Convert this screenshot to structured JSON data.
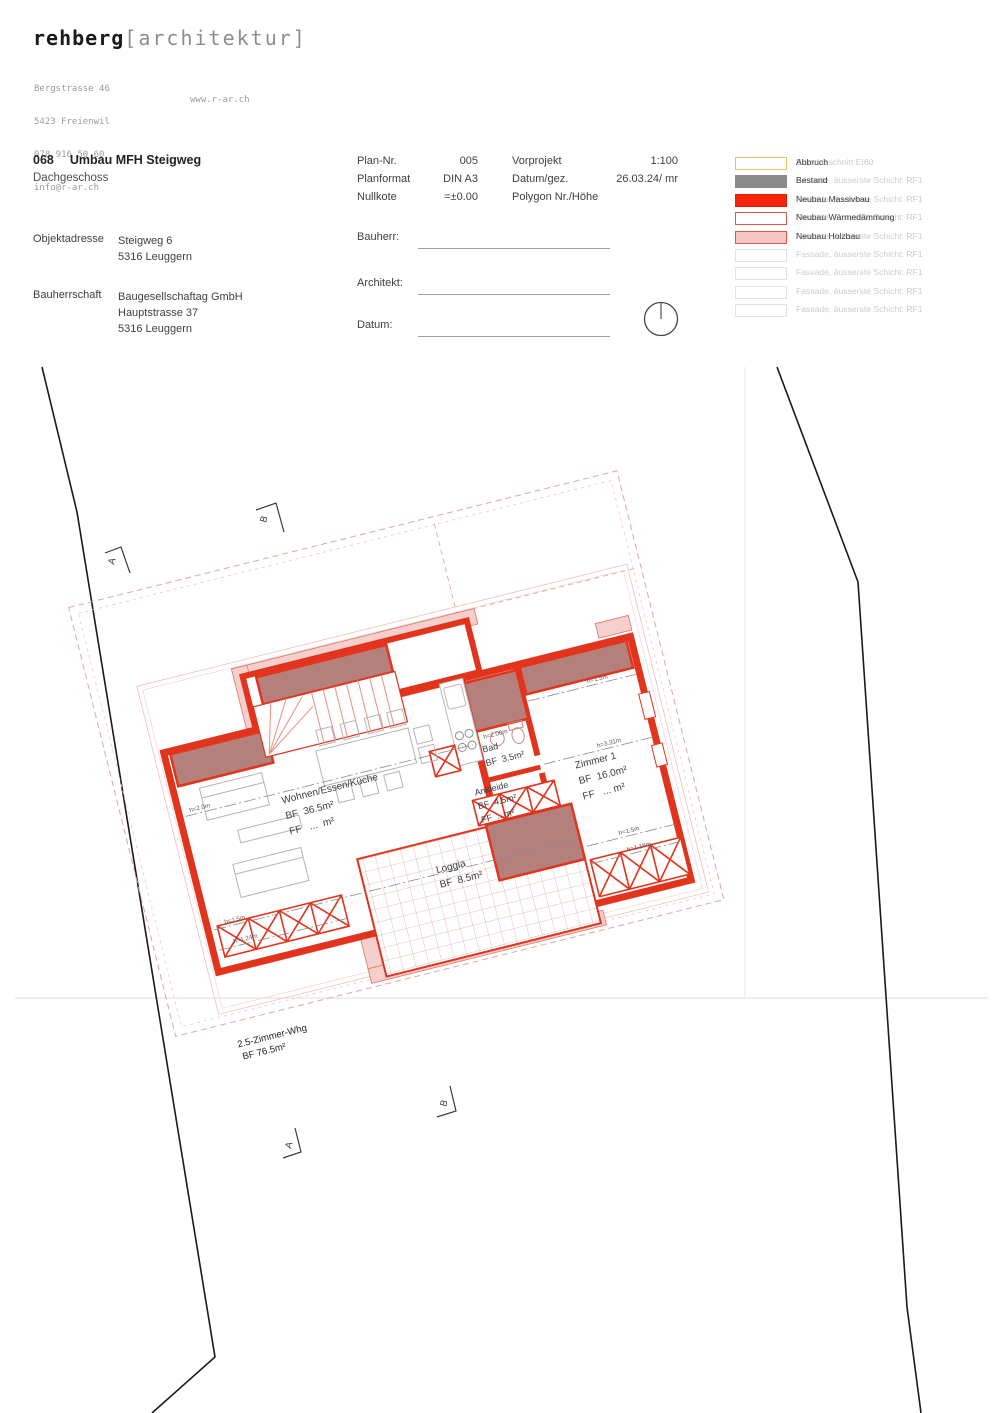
{
  "brand": {
    "name": "rehberg",
    "bracket": "[architektur]",
    "address_lines": [
      "Bergstrasse 46",
      "5423 Freienwil",
      "078 916 50 60",
      "info@r-ar.ch"
    ],
    "website": "www.r-ar.ch"
  },
  "title_block": {
    "project_number": "068",
    "project_title": "Umbau MFH Steigweg",
    "floor": "Dachgeschoss",
    "object_address_label": "Objektadresse",
    "object_address_lines": [
      "Steigweg 6",
      "5316 Leuggern"
    ],
    "client_label": "Bauherrschaft",
    "client_lines": [
      "Baugesellschaftag GmbH",
      "Hauptstrasse 37",
      "5316 Leuggern"
    ]
  },
  "plan_meta": {
    "rows_left": [
      {
        "label": "Plan-Nr.",
        "value": "005"
      },
      {
        "label": "Planformat",
        "value": "DIN A3"
      },
      {
        "label": "Nullkote",
        "value": "=±0.00"
      }
    ],
    "rows_right": [
      {
        "label": "Vorprojekt",
        "value": "1:100"
      },
      {
        "label": "Datum/gez.",
        "value": "26.03.24/ mr"
      },
      {
        "label": "Polygon Nr./Höhe",
        "value": ""
      }
    ],
    "signature_fields": [
      "Bauherr:",
      "Architekt:",
      "Datum:"
    ]
  },
  "legend": {
    "rows": [
      {
        "label": "Abbruch",
        "ghost": "Brandabschnitt EI60",
        "swatch_style": "background:#ffffff;border:1px solid #e6c06a"
      },
      {
        "label": "Bestand",
        "ghost": "Fassade, äusserste Schicht: RF1",
        "swatch_style": "background:#8a8a8a;border:1px solid #8a8a8a"
      },
      {
        "label": "Neubau Massivbau",
        "ghost": "Fassade, äusserste Schicht: RF1",
        "swatch_style": "background:#f92408;border:1px solid #e02008"
      },
      {
        "label": "Neubau Wärmedämmung",
        "ghost": "Fassade, äusserste Schicht: RF1",
        "swatch_style": "background:#ffffff;border:1.5px solid #e0544a"
      },
      {
        "label": "Neubau Holzbau",
        "ghost": "Fassade, äusserste Schicht: RF1",
        "swatch_style": "background:#f6c6c5;border:1.5px solid #e0544a"
      },
      {
        "label": "",
        "ghost": "Fassade, äusserste Schicht: RF1",
        "swatch_style": "background:#ffffff;border:1px solid #e3e3e3"
      },
      {
        "label": "",
        "ghost": "Fassade, äusserste Schicht: RF1",
        "swatch_style": "background:#ffffff;border:1px solid #e3e3e3"
      },
      {
        "label": "",
        "ghost": "Fassade, äusserste Schicht: RF1",
        "swatch_style": "background:#ffffff;border:1px solid #e3e3e3"
      },
      {
        "label": "",
        "ghost": "Fassade, äusserste Schicht: RF1",
        "swatch_style": "background:#ffffff;border:1px solid #e3e3e3"
      }
    ]
  },
  "plan": {
    "rooms": [
      {
        "name": "Wohnen/Essen/Küche",
        "bf": "BF  36.5m²",
        "ff": "FF   ...  m²"
      },
      {
        "name": "Bad",
        "bf": "BF  3.5m²",
        "ff": ""
      },
      {
        "name": "Ankleide",
        "bf": "BF  4.5m²",
        "ff": "FF  ...m²"
      },
      {
        "name": "Zimmer 1",
        "bf": "BF  16.0m²",
        "ff": "FF   ... m²"
      },
      {
        "name": "Loggia",
        "bf": "BF  8.5m²",
        "ff": ""
      }
    ],
    "height_labels": [
      "h=2.0m",
      "h=1.5m",
      "h=1.24m",
      "h=2.00m",
      "h=1.5m",
      "h=3.31m",
      "h=1.5m",
      "h=1.16m"
    ],
    "apartment_label": {
      "line1": "2.5-Zimmer-Whg",
      "line2": "BF 76.5m²"
    },
    "section_markers": {
      "a": "A",
      "b": "B"
    },
    "colors": {
      "wall_red": "#e2331c",
      "existing_fill": "#b5807c",
      "timber_pink": "#f5cfcc",
      "roof_dash": "#dfa6a3",
      "legend_red": "#f92408",
      "legend_gold": "#e6c06a",
      "legend_gray": "#8a8a8a"
    }
  }
}
